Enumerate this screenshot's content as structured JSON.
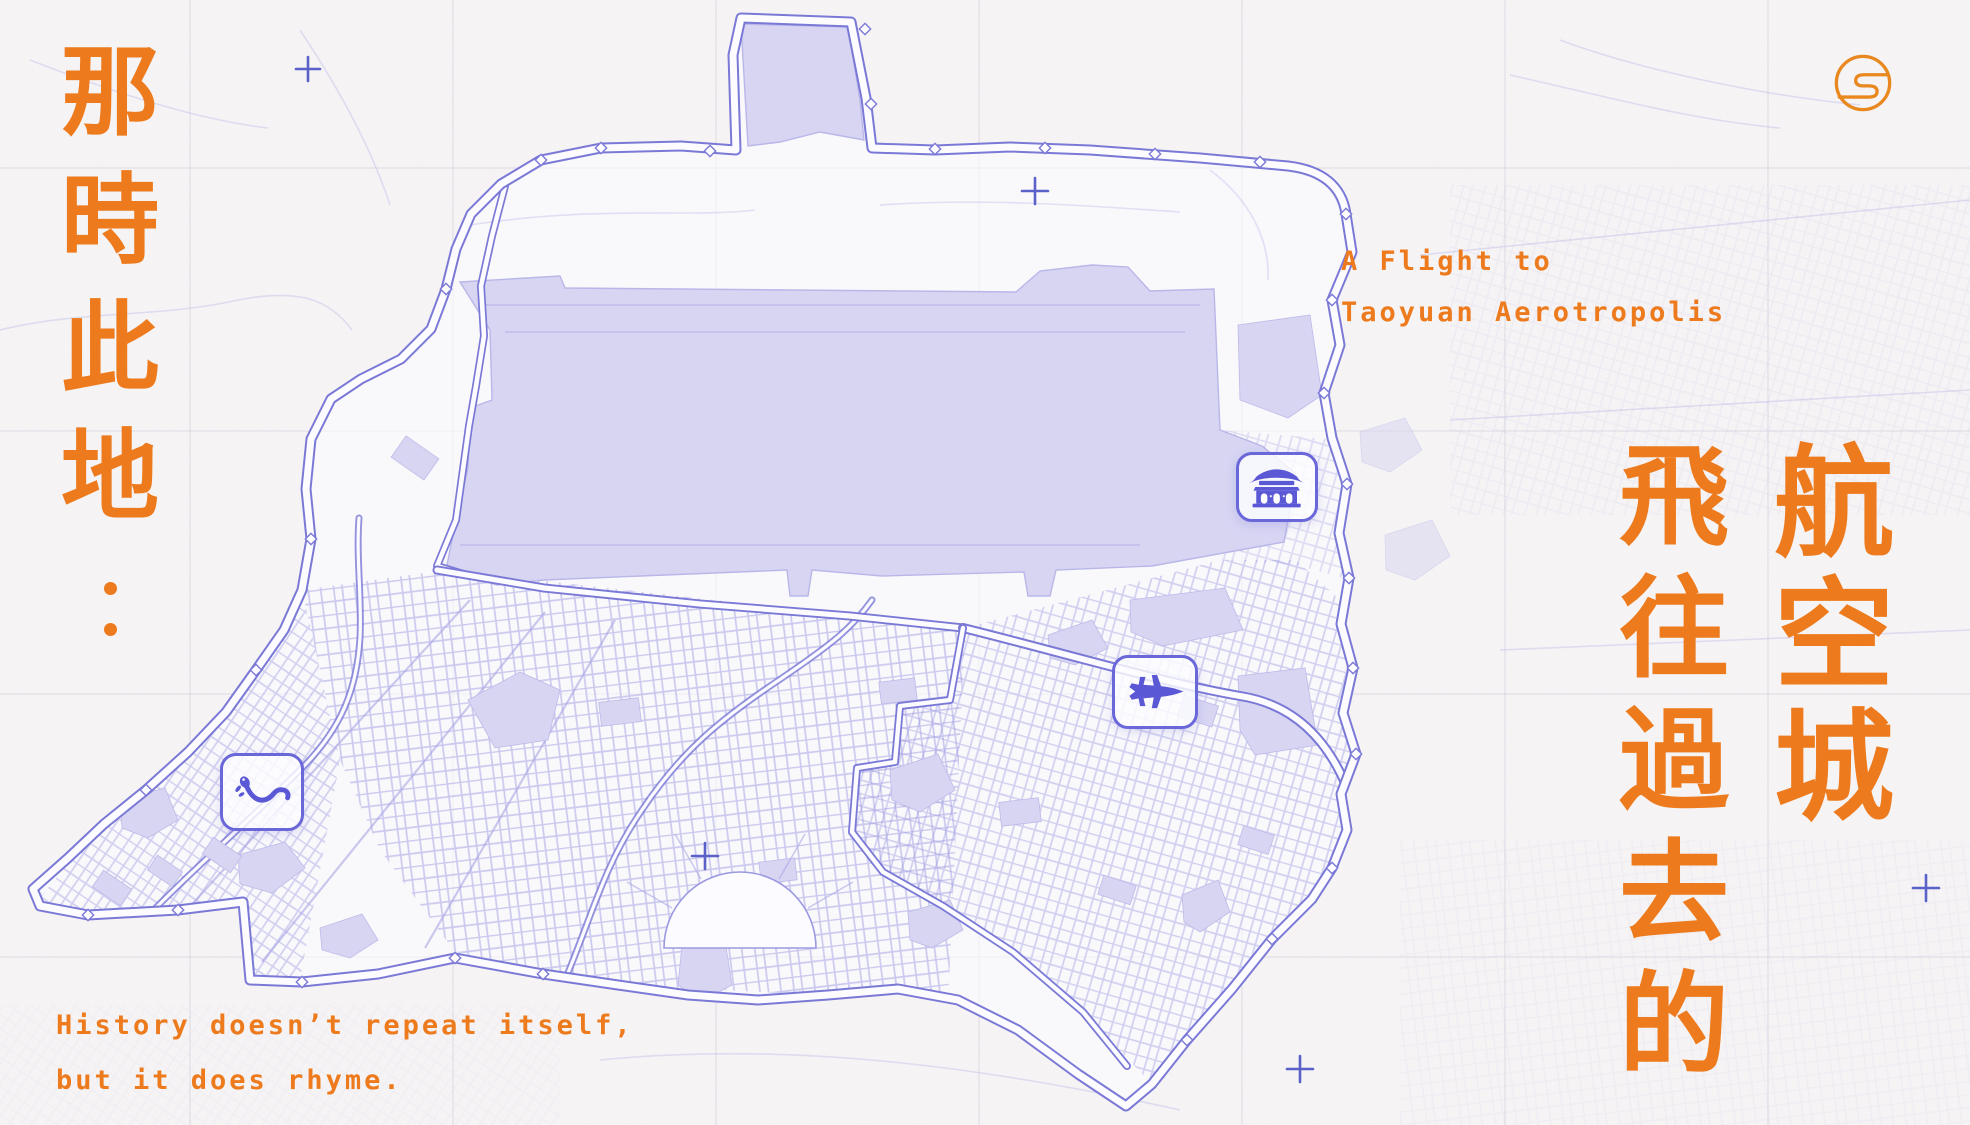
{
  "poster": {
    "title_zh_vertical": "那時此地：",
    "headline_zh_col_right": "航空城",
    "headline_zh_col_left": "飛往過去的",
    "subtitle_en": {
      "line1": "A Flight to",
      "line2": "Taoyuan Aerotropolis"
    },
    "quote_en": {
      "line1": "History doesn’t repeat itself,",
      "line2": "but it does rhyme."
    }
  },
  "map": {
    "name": "taoyuan-aerotropolis-map",
    "markers": [
      {
        "icon": "temple-icon"
      },
      {
        "icon": "fighter-jet-icon"
      },
      {
        "icon": "salamander-icon"
      }
    ],
    "decorations": {
      "plus_marker_count": 5
    }
  },
  "logo": {
    "icon": "s-monogram-logo"
  },
  "colors": {
    "accent_orange": "#ED7B1E",
    "logo_orange": "#E8881F",
    "map_purple": "#7B79D6",
    "map_line_light": "#A8A6E4",
    "grid_street": "#8F8DDE",
    "map_fill": "#D7D5F2",
    "icon_purple": "#5B58D6",
    "badge_purple": "#6A67D8",
    "marker_blue": "#5A61C8",
    "background": "#F7F5F4",
    "paper_inner": "#FCFBFF"
  }
}
